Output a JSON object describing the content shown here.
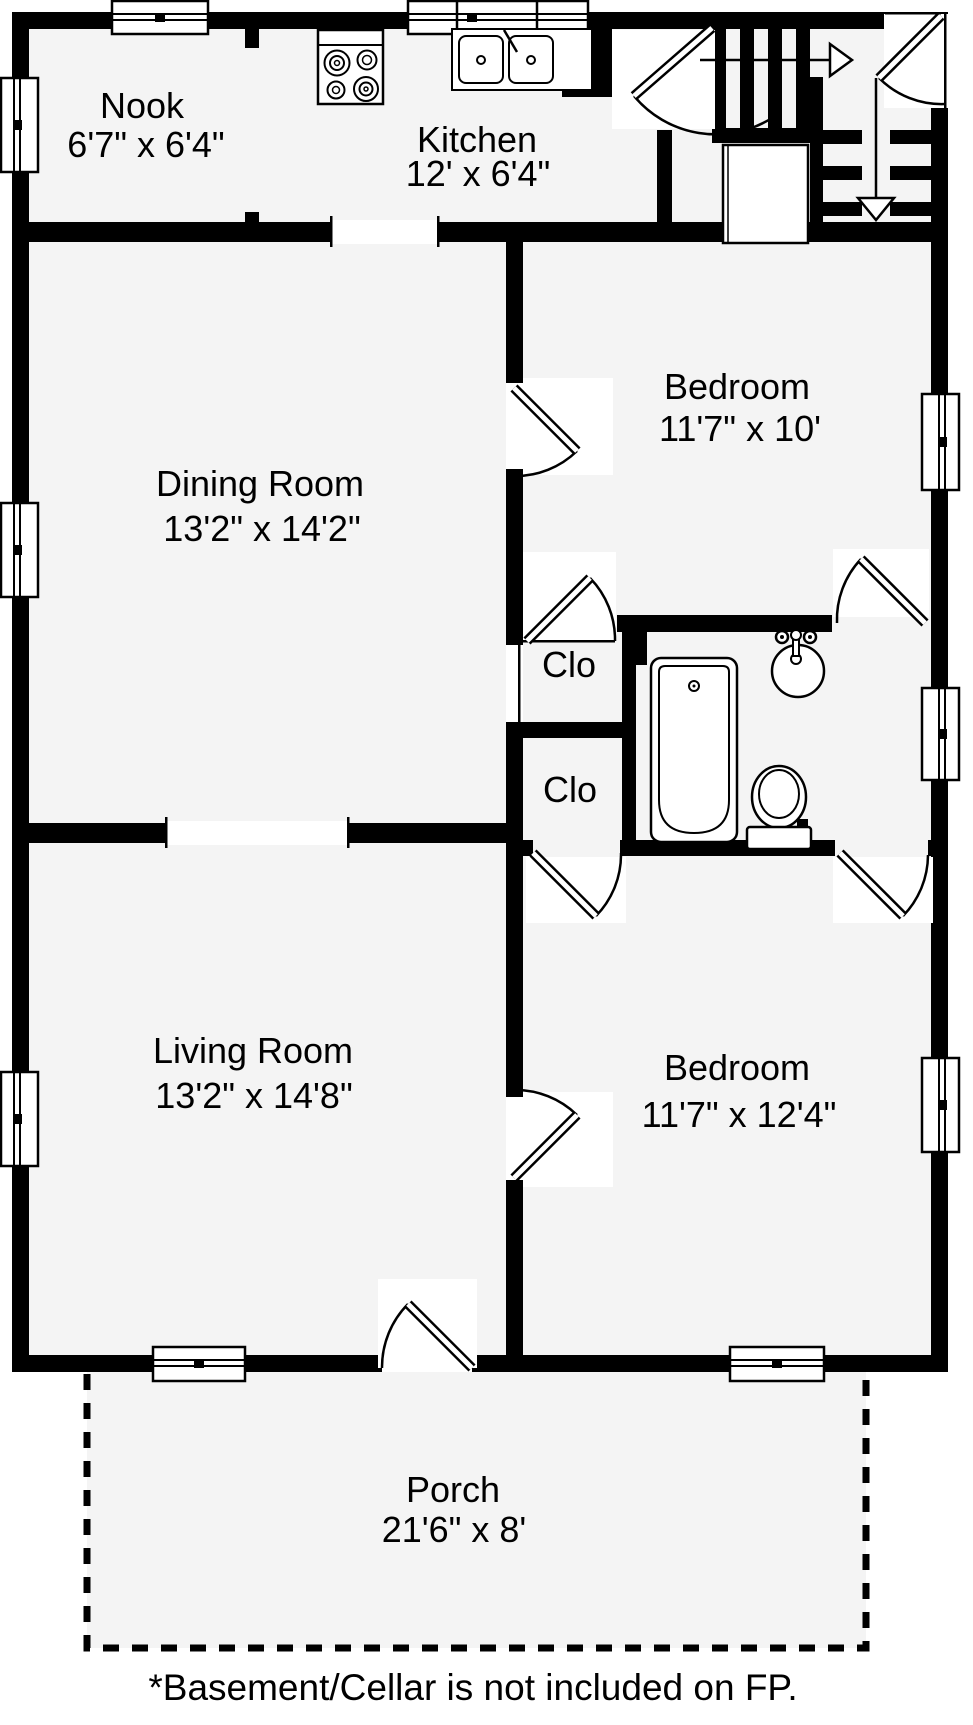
{
  "title": "Floor plan",
  "note": "*Basement/Cellar is not included on FP.",
  "rooms": [
    {
      "name": "Nook",
      "dims": "6'7\" x 6'4\""
    },
    {
      "name": "Kitchen",
      "dims": "12' x 6'4\""
    },
    {
      "name": "Dining Room",
      "dims": "13'2\" x 14'2\""
    },
    {
      "name": "Bedroom",
      "dims": "11'7\" x 10'"
    },
    {
      "name": "Clo",
      "dims": ""
    },
    {
      "name": "Clo",
      "dims": ""
    },
    {
      "name": "Living Room",
      "dims": "13'2\" x 14'8\""
    },
    {
      "name": "Bedroom",
      "dims": "11'7\" x 12'4\""
    },
    {
      "name": "Porch",
      "dims": "21'6\" x 8'"
    }
  ],
  "fixtures": [
    "stove",
    "kitchen-sink",
    "refrigerator",
    "staircase-up",
    "staircase-down",
    "bathtub",
    "bathroom-sink",
    "toilet"
  ],
  "colors": {
    "wall": "#000000",
    "floor": "#f4f4f4",
    "swing_area": "#ffffff",
    "background": "#ffffff"
  }
}
